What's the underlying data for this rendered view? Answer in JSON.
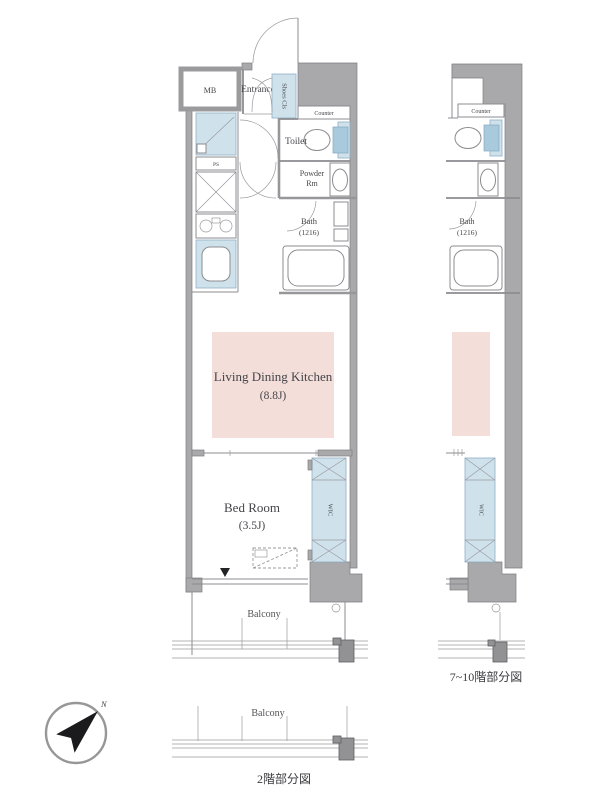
{
  "main_plan": {
    "mb": "MB",
    "entrance": "Entrance",
    "shoes_closet": "Shoes Cls",
    "counter": "Counter",
    "toilet": "Toilet",
    "powder_line1": "Powder",
    "powder_line2": "Rm",
    "bath_line1": "Bath",
    "bath_line2": "(1216)",
    "pipe_space": "PS",
    "ldk_line1": "Living Dining Kitchen",
    "ldk_line2": "(8.8J)",
    "bedroom_line1": "Bed Room",
    "bedroom_line2": "(3.5J)",
    "wic": "WIC",
    "balcony": "Balcony"
  },
  "upper_sub_plan": {
    "counter": "Counter",
    "bath_line1": "Bath",
    "bath_line2": "(1216)",
    "wic": "WIC",
    "caption": "7~10階部分図"
  },
  "lower_sub_plan": {
    "balcony": "Balcony",
    "caption": "2階部分図"
  },
  "compass": {
    "north": "N"
  },
  "colors": {
    "wall_gray": "#a9a9ac",
    "water_blue": "#cfe2ec",
    "ldk_pink": "#f3ded9",
    "line_gray": "#8c8c90"
  }
}
